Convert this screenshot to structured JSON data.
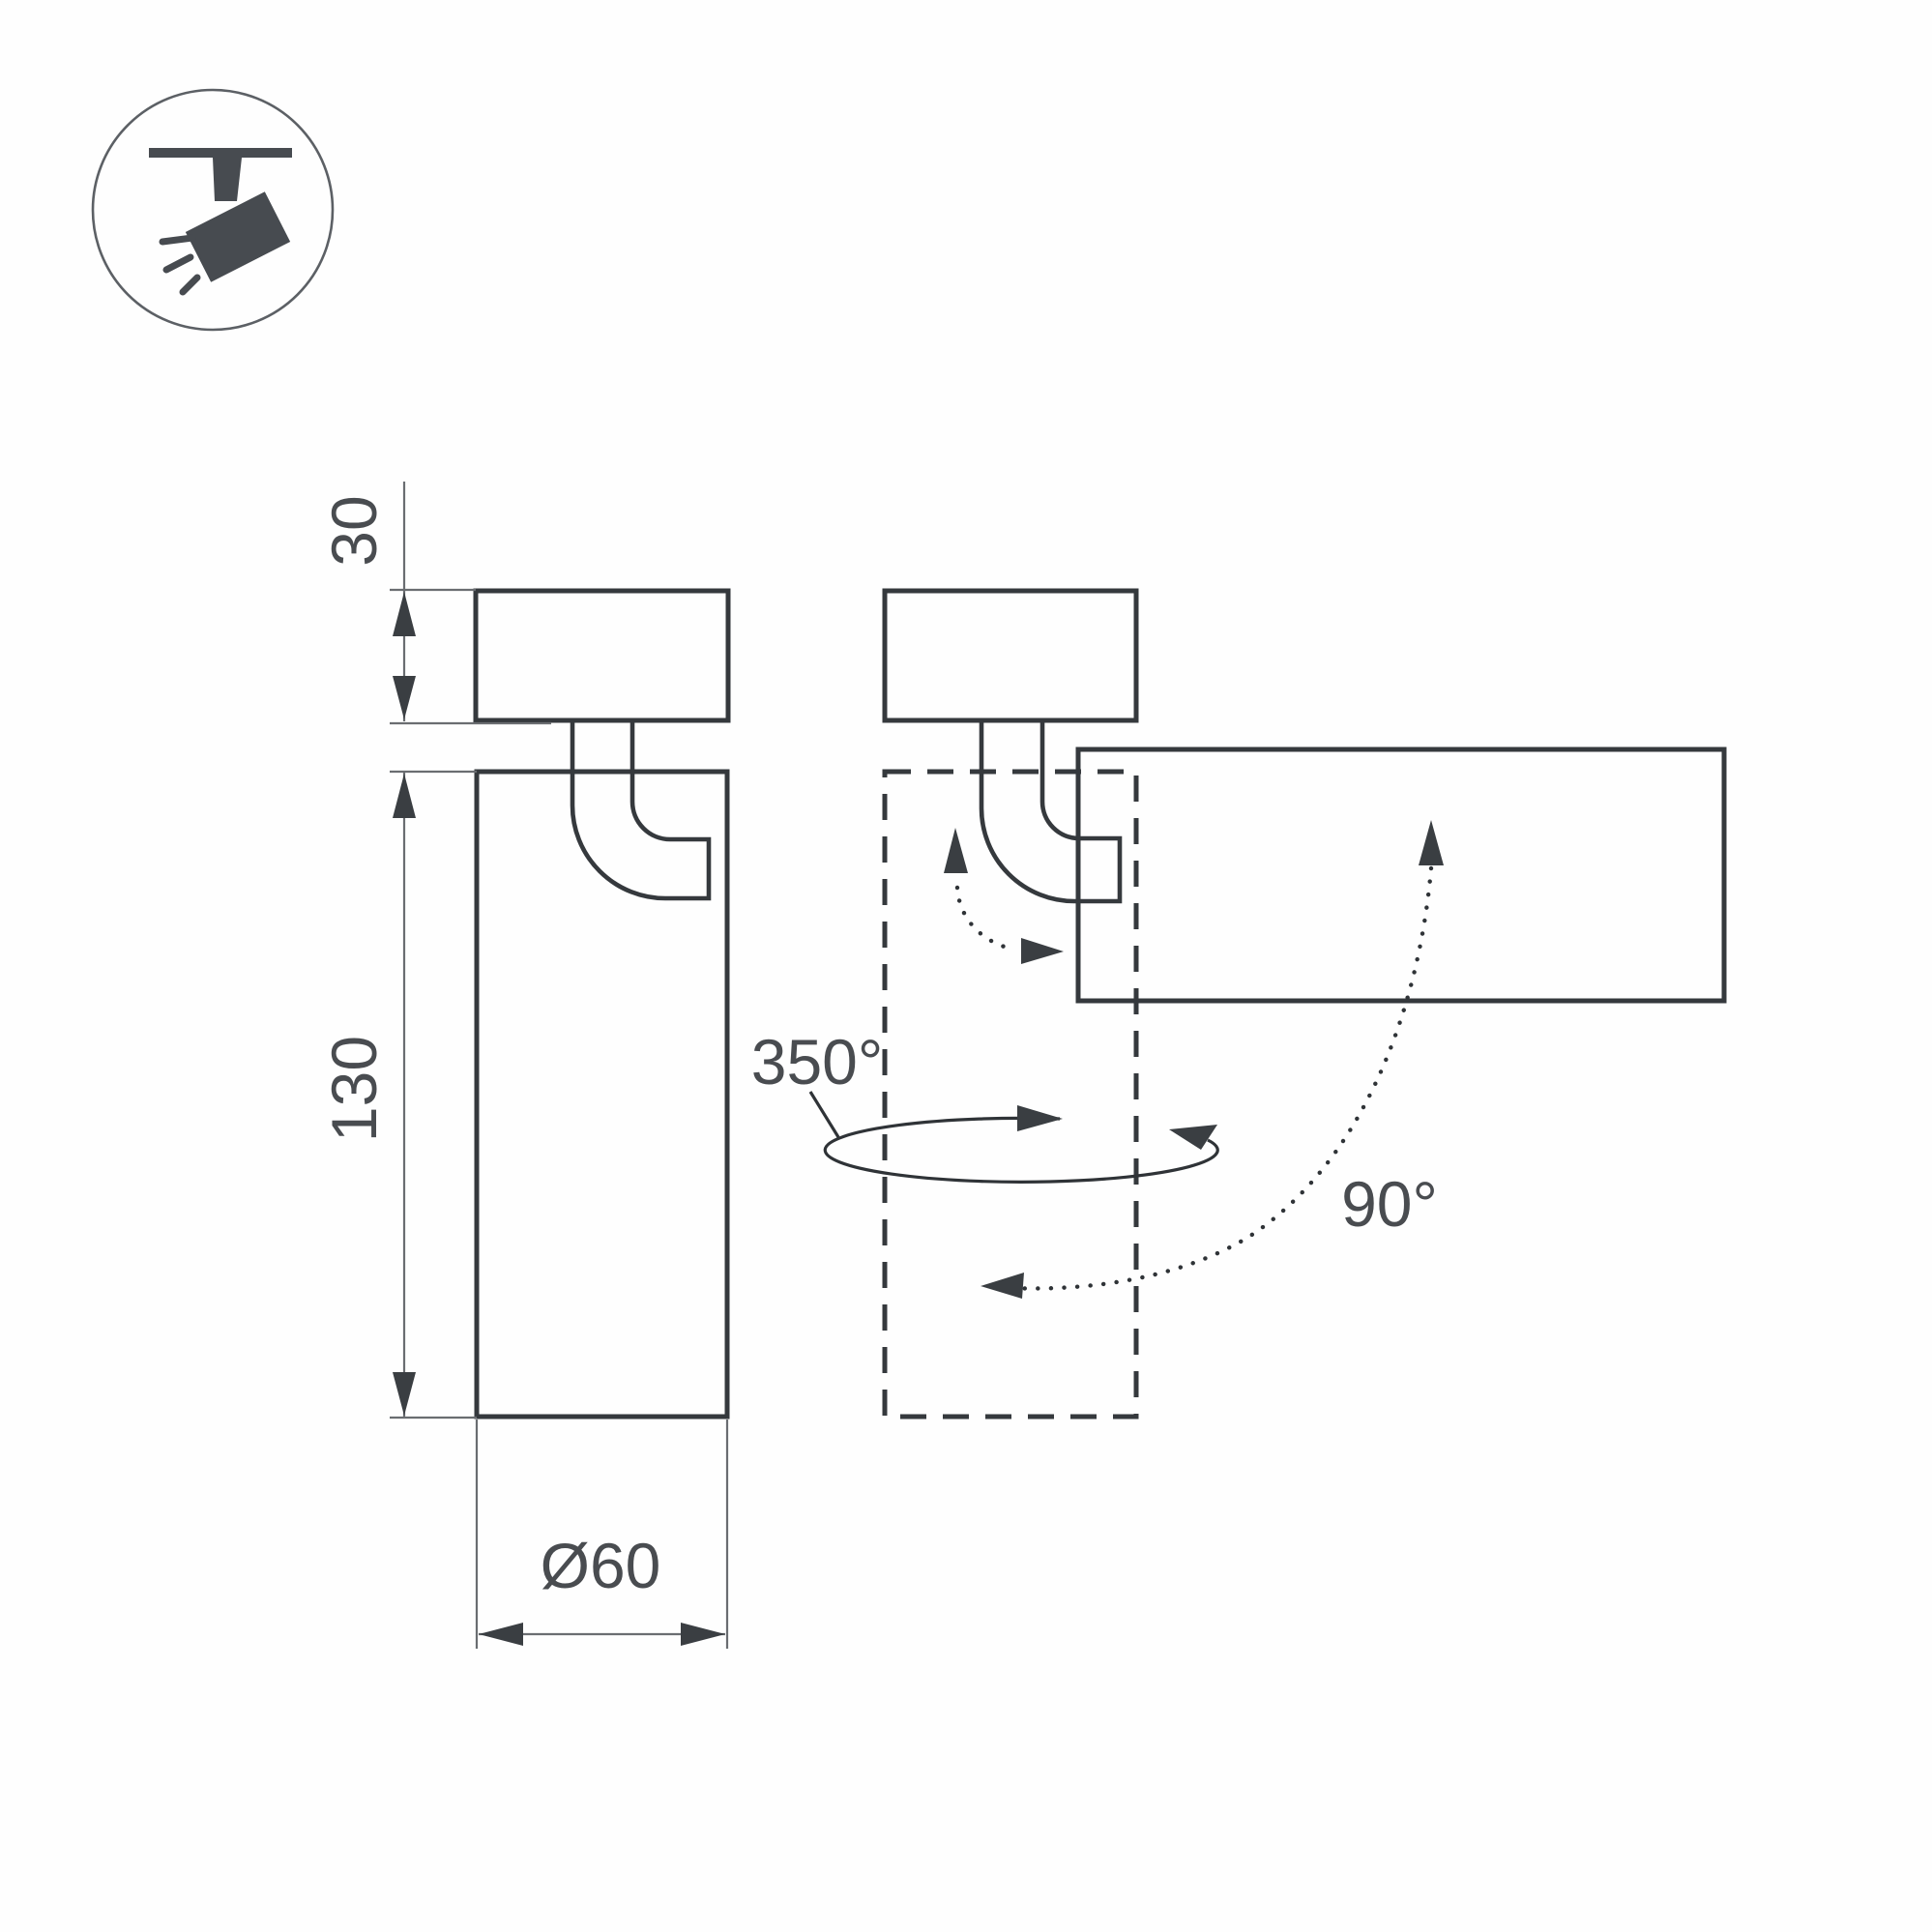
{
  "diagram": {
    "title_hint": "luminaire mounting and rotation dimension drawing",
    "dimension_labels": {
      "mount_height": "30",
      "body_length": "130",
      "diameter": "Ø60"
    },
    "rotation_labels": {
      "swivel": "350°",
      "tilt": "90°"
    },
    "icon": "ceiling-track-spotlight-icon",
    "colors": {
      "background": "#ffffff",
      "outline": "#35393d",
      "thin_dimension_line": "#6a6d71",
      "text": "#494c50",
      "icon": "#474b50"
    }
  }
}
